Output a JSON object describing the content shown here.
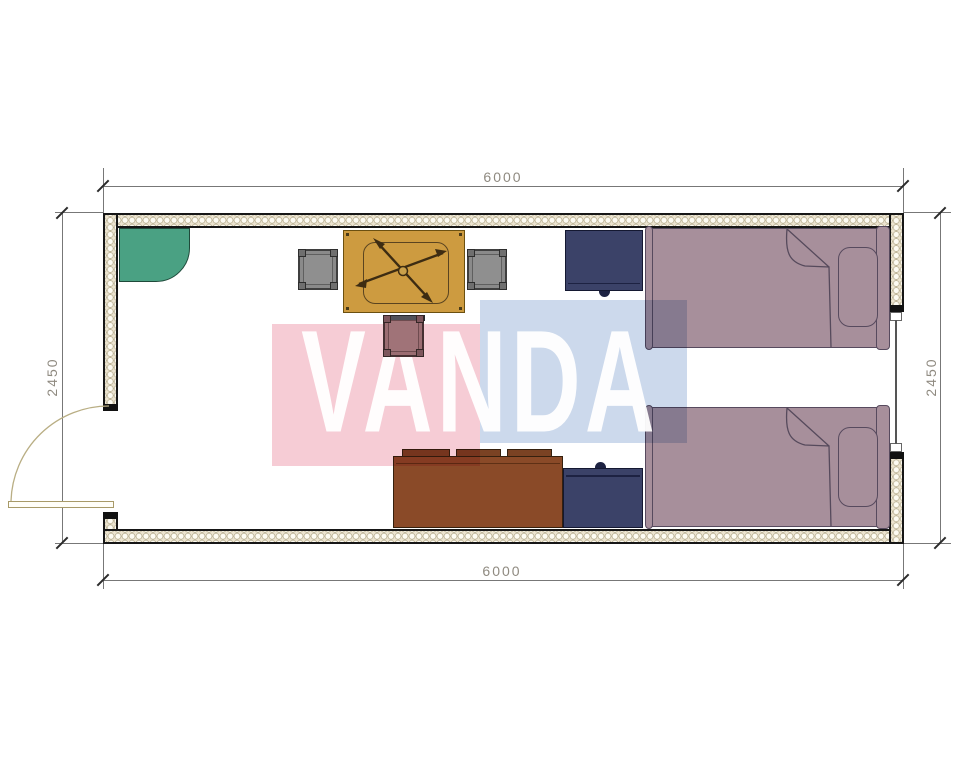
{
  "drawing": {
    "type": "floor-plan",
    "watermark": {
      "text": "VANDA",
      "pink_color": "#f6ccd5",
      "blue_color": "#ccd9ec",
      "text_color": "#ffffff"
    },
    "dimensions": {
      "width_top": "6000",
      "width_bottom": "6000",
      "height_left": "2450",
      "height_right": "2450"
    },
    "room": {
      "wall_fill_color": "#ece4d0",
      "wall_line_color": "#161616",
      "floor_color": "#ffffff",
      "openings": [
        "door-left",
        "window-right"
      ],
      "furniture": [
        {
          "name": "corner-shelf",
          "color": "#4aa183"
        },
        {
          "name": "dining-table",
          "color": "#cd9b40"
        },
        {
          "name": "chair-left",
          "color": "#8a8a8a"
        },
        {
          "name": "chair-right",
          "color": "#8a8a8a"
        },
        {
          "name": "chair-bottom",
          "color": "#9b6d72"
        },
        {
          "name": "nightstand-upper",
          "color": "#3b4268"
        },
        {
          "name": "nightstand-lower",
          "color": "#3b4268"
        },
        {
          "name": "sideboard",
          "color": "#8a4a28"
        },
        {
          "name": "bed-upper",
          "color": "#a78f9b"
        },
        {
          "name": "bed-lower",
          "color": "#a78f9b"
        }
      ]
    }
  }
}
